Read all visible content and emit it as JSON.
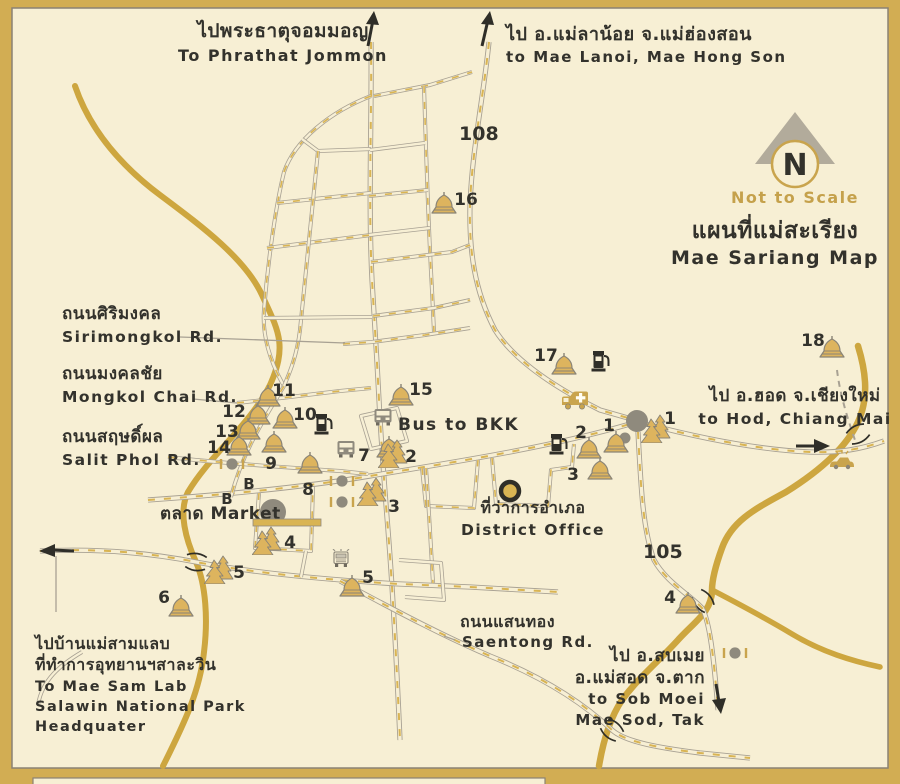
{
  "title": {
    "th": "แผนที่แม่สะเรียง",
    "en": "Mae Sariang Map"
  },
  "compass": {
    "letter": "N",
    "note": "Not to Scale"
  },
  "routes": {
    "north_highway": "108",
    "south_highway": "105"
  },
  "destinations": {
    "north_west": {
      "th": "ไปพระธาตุจอมมอญ",
      "en": "To Phrathat Jommon"
    },
    "north_east": {
      "th": "ไป อ.แม่ลาน้อย จ.แม่ฮ่องสอน",
      "en": "to Mae Lanoi, Mae Hong Son"
    },
    "east": {
      "th": "ไป อ.ฮอด จ.เชียงใหม่",
      "en": "to Hod, Chiang Mai"
    },
    "south_east": {
      "th_line1": "ไป อ.สบเมย",
      "th_line2": "อ.แม่สอด จ.ตาก",
      "en_line1": "to Sob Moei",
      "en_line2": "Mae Sod, Tak"
    },
    "west": {
      "th_line1": "ไปบ้านแม่สามแลบ",
      "th_line2": "ที่ทำการอุทยานฯสาละวิน",
      "en_line1": "To Mae Sam Lab",
      "en_line2": "Salawin National Park",
      "en_line3": "Headquater"
    }
  },
  "streets": {
    "sirimongkol": {
      "th": "ถนนศิริมงคล",
      "en": "Sirimongkol Rd."
    },
    "mongkol_chai": {
      "th": "ถนนมงคลชัย",
      "en": "Mongkol Chai Rd."
    },
    "salit_phol": {
      "th": "ถนนสฤษดิ์ผล",
      "en": "Salit Phol Rd."
    },
    "saentong": {
      "th": "ถนนแสนทอง",
      "en": "Saentong Rd."
    }
  },
  "places": {
    "bus_to_bkk": "Bus to BKK",
    "market": "ตลาด Market",
    "district_office": {
      "th": "ที่ว่าการอำเภอ",
      "en": "District Office"
    },
    "bus_stop_letter": "B"
  },
  "markers": {
    "temples": [
      {
        "num": "1",
        "x": 616,
        "y": 452,
        "lx": 609,
        "ly": 431
      },
      {
        "num": "2",
        "x": 589,
        "y": 458,
        "lx": 581,
        "ly": 438
      },
      {
        "num": "3",
        "x": 600,
        "y": 479,
        "lx": 573,
        "ly": 480
      },
      {
        "num": "4",
        "x": 688,
        "y": 613,
        "lx": 670,
        "ly": 603
      },
      {
        "num": "5",
        "x": 352,
        "y": 596,
        "lx": 368,
        "ly": 583
      },
      {
        "num": "6",
        "x": 181,
        "y": 616,
        "lx": 164,
        "ly": 603
      },
      {
        "num": "7",
        "x": 389,
        "y": 457,
        "lx": 364,
        "ly": 461
      },
      {
        "num": "8",
        "x": 310,
        "y": 473,
        "lx": 308,
        "ly": 495
      },
      {
        "num": "9",
        "x": 274,
        "y": 452,
        "lx": 271,
        "ly": 469
      },
      {
        "num": "10",
        "x": 285,
        "y": 428,
        "lx": 305,
        "ly": 420
      },
      {
        "num": "11",
        "x": 268,
        "y": 406,
        "lx": 284,
        "ly": 396
      },
      {
        "num": "12",
        "x": 258,
        "y": 424,
        "lx": 234,
        "ly": 417
      },
      {
        "num": "13",
        "x": 248,
        "y": 439,
        "lx": 227,
        "ly": 437
      },
      {
        "num": "14",
        "x": 239,
        "y": 455,
        "lx": 219,
        "ly": 453
      },
      {
        "num": "15",
        "x": 401,
        "y": 405,
        "lx": 421,
        "ly": 395
      },
      {
        "num": "16",
        "x": 444,
        "y": 213,
        "lx": 466,
        "ly": 205
      },
      {
        "num": "17",
        "x": 564,
        "y": 374,
        "lx": 546,
        "ly": 361
      },
      {
        "num": "18",
        "x": 832,
        "y": 357,
        "lx": 813,
        "ly": 346
      }
    ],
    "sites": [
      {
        "num": "1",
        "x": 656,
        "y": 442,
        "lx": 670,
        "ly": 424
      },
      {
        "num": "2",
        "x": 393,
        "y": 467,
        "lx": 411,
        "ly": 462
      },
      {
        "num": "3",
        "x": 372,
        "y": 505,
        "lx": 394,
        "ly": 512
      },
      {
        "num": "4",
        "x": 267,
        "y": 554,
        "lx": 290,
        "ly": 548
      },
      {
        "num": "5",
        "x": 219,
        "y": 583,
        "lx": 239,
        "ly": 578
      }
    ],
    "bus_stops": [
      {
        "x": 249,
        "y": 489
      },
      {
        "x": 227,
        "y": 504
      }
    ]
  },
  "icons": [
    {
      "name": "fuel-pump-icon",
      "x": 323,
      "y": 433
    },
    {
      "name": "fuel-pump-icon",
      "x": 558,
      "y": 453
    },
    {
      "name": "fuel-pump-icon",
      "x": 600,
      "y": 370
    },
    {
      "name": "bus-icon",
      "x": 383,
      "y": 417
    },
    {
      "name": "bus-icon",
      "x": 346,
      "y": 449
    },
    {
      "name": "ambulance-icon",
      "x": 575,
      "y": 400
    },
    {
      "name": "car-icon",
      "x": 842,
      "y": 462
    },
    {
      "name": "truck-icon",
      "x": 341,
      "y": 558
    },
    {
      "name": "market-circle-icon",
      "x": 273,
      "y": 512
    },
    {
      "name": "district-office-icon",
      "x": 510,
      "y": 491
    },
    {
      "name": "roundabout-icon",
      "x": 637,
      "y": 421
    },
    {
      "name": "junction-dot-icon",
      "x": 625,
      "y": 438
    },
    {
      "name": "checkpoint-icon",
      "x": 232,
      "y": 464
    },
    {
      "name": "checkpoint-icon",
      "x": 342,
      "y": 481
    },
    {
      "name": "checkpoint-icon",
      "x": 342,
      "y": 502
    },
    {
      "name": "checkpoint-icon",
      "x": 735,
      "y": 653
    }
  ],
  "colors": {
    "page_gold": "#d2ad53",
    "panel_cream": "#f7efd4",
    "river_gold": "#cda63f",
    "road_casing": "#a8a193",
    "road_dash_gold": "#d9b453",
    "ink_black": "#33322c",
    "accent_gold_text": "#c5a14b",
    "gray_marker": "#9b9585",
    "icon_gray": "#8f8a7d",
    "temple_gold": "#ddb45e"
  }
}
